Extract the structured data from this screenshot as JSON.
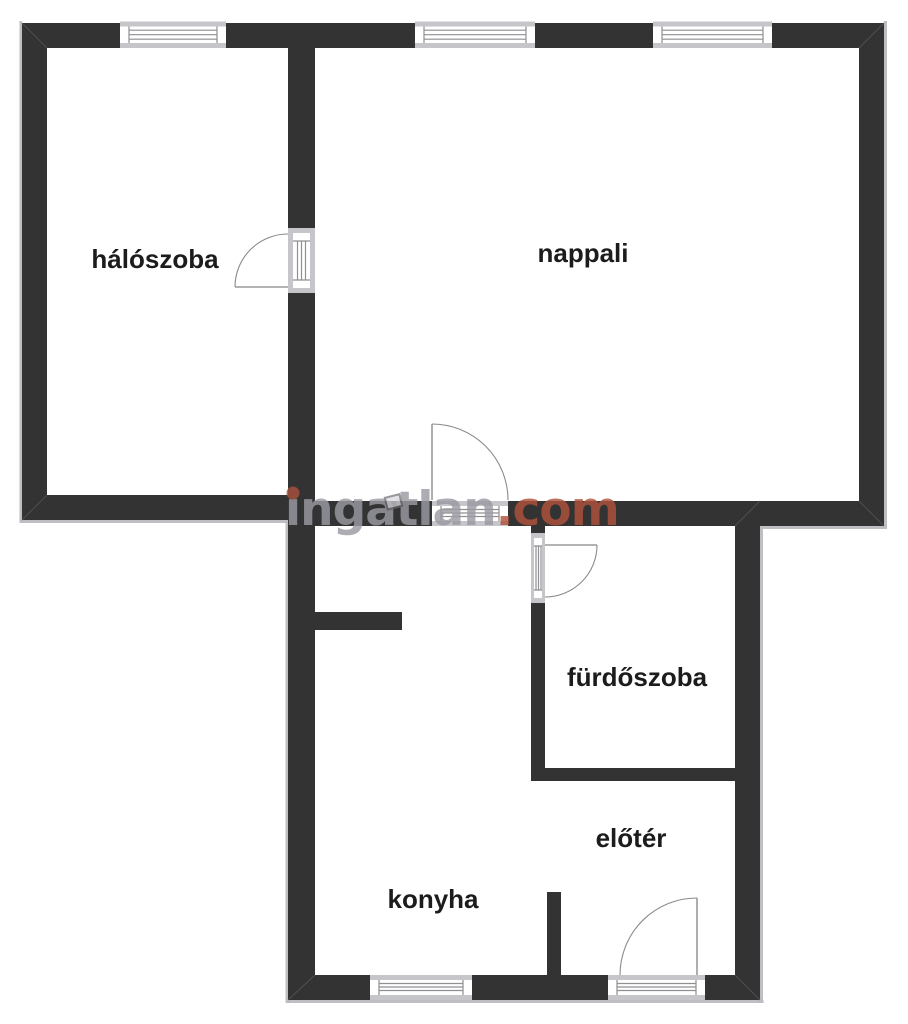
{
  "floorplan": {
    "rooms": [
      {
        "id": "haloszoba",
        "label": "hálószoba"
      },
      {
        "id": "nappali",
        "label": "nappali"
      },
      {
        "id": "furdoszoba",
        "label": "fürdőszoba"
      },
      {
        "id": "eloter",
        "label": "előtér"
      },
      {
        "id": "konyha",
        "label": "konyha"
      }
    ],
    "watermark": {
      "text": "ingatlan.com",
      "gray_part": "ingatlan",
      "red_part": ".com"
    },
    "colors": {
      "background": "#ffffff",
      "wall": "#333333",
      "window_frame_gray": "#c6c6ca",
      "window_line": "#8f8f94",
      "door_line": "#8a8a8a",
      "exterior_outline": "#bfbfc3",
      "label_text": "#1c1c1c",
      "watermark_gray": "#9a9aa2",
      "watermark_red": "#b0523c"
    }
  }
}
